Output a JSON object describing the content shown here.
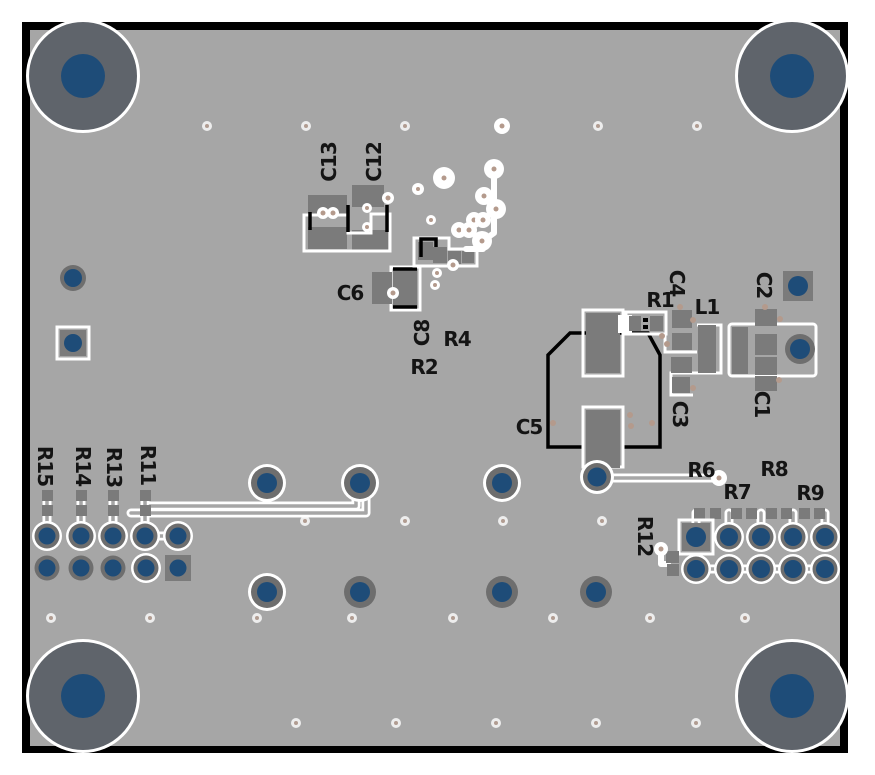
{
  "title": "PCB assembly top view",
  "colors": {
    "board": "#a6a6a6",
    "edge": "#000000",
    "silk": "#ffffff",
    "pad": "#7b7b7b",
    "annulus": "#6e6e6e",
    "mount": "#5f646b",
    "drill": "#1e4c78",
    "copper": "#b49a8c",
    "label": "#141414"
  },
  "labels": {
    "c1": "C1",
    "c2": "C2",
    "c3": "C3",
    "c4": "C4",
    "c5": "C5",
    "c6": "C6",
    "c8": "C8",
    "c12": "C12",
    "c13": "C13",
    "l1": "L1",
    "r1": "R1",
    "r2": "R2",
    "r4": "R4",
    "r6": "R6",
    "r7": "R7",
    "r8": "R8",
    "r9": "R9",
    "r11": "R11",
    "r12": "R12",
    "r13": "R13",
    "r14": "R14",
    "r15": "R15"
  }
}
